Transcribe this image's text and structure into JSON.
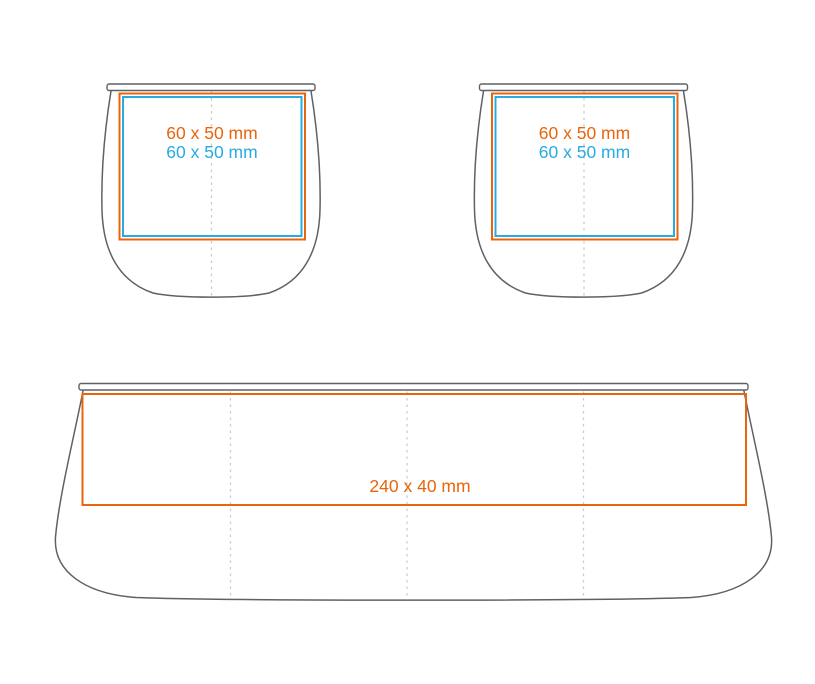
{
  "colors": {
    "print_area_primary": "#E8650C",
    "print_area_secondary": "#29ABE2",
    "product_outline": "#5F6164",
    "fold_line": "#CBCBCB"
  },
  "views": {
    "cup_left": {
      "label_primary": "60 x 50 mm",
      "label_secondary": "60 x 50 mm"
    },
    "cup_right": {
      "label_primary": "60 x 50 mm",
      "label_secondary": "60 x 50 mm"
    },
    "wrap": {
      "label_primary": "240 x 40 mm"
    }
  }
}
